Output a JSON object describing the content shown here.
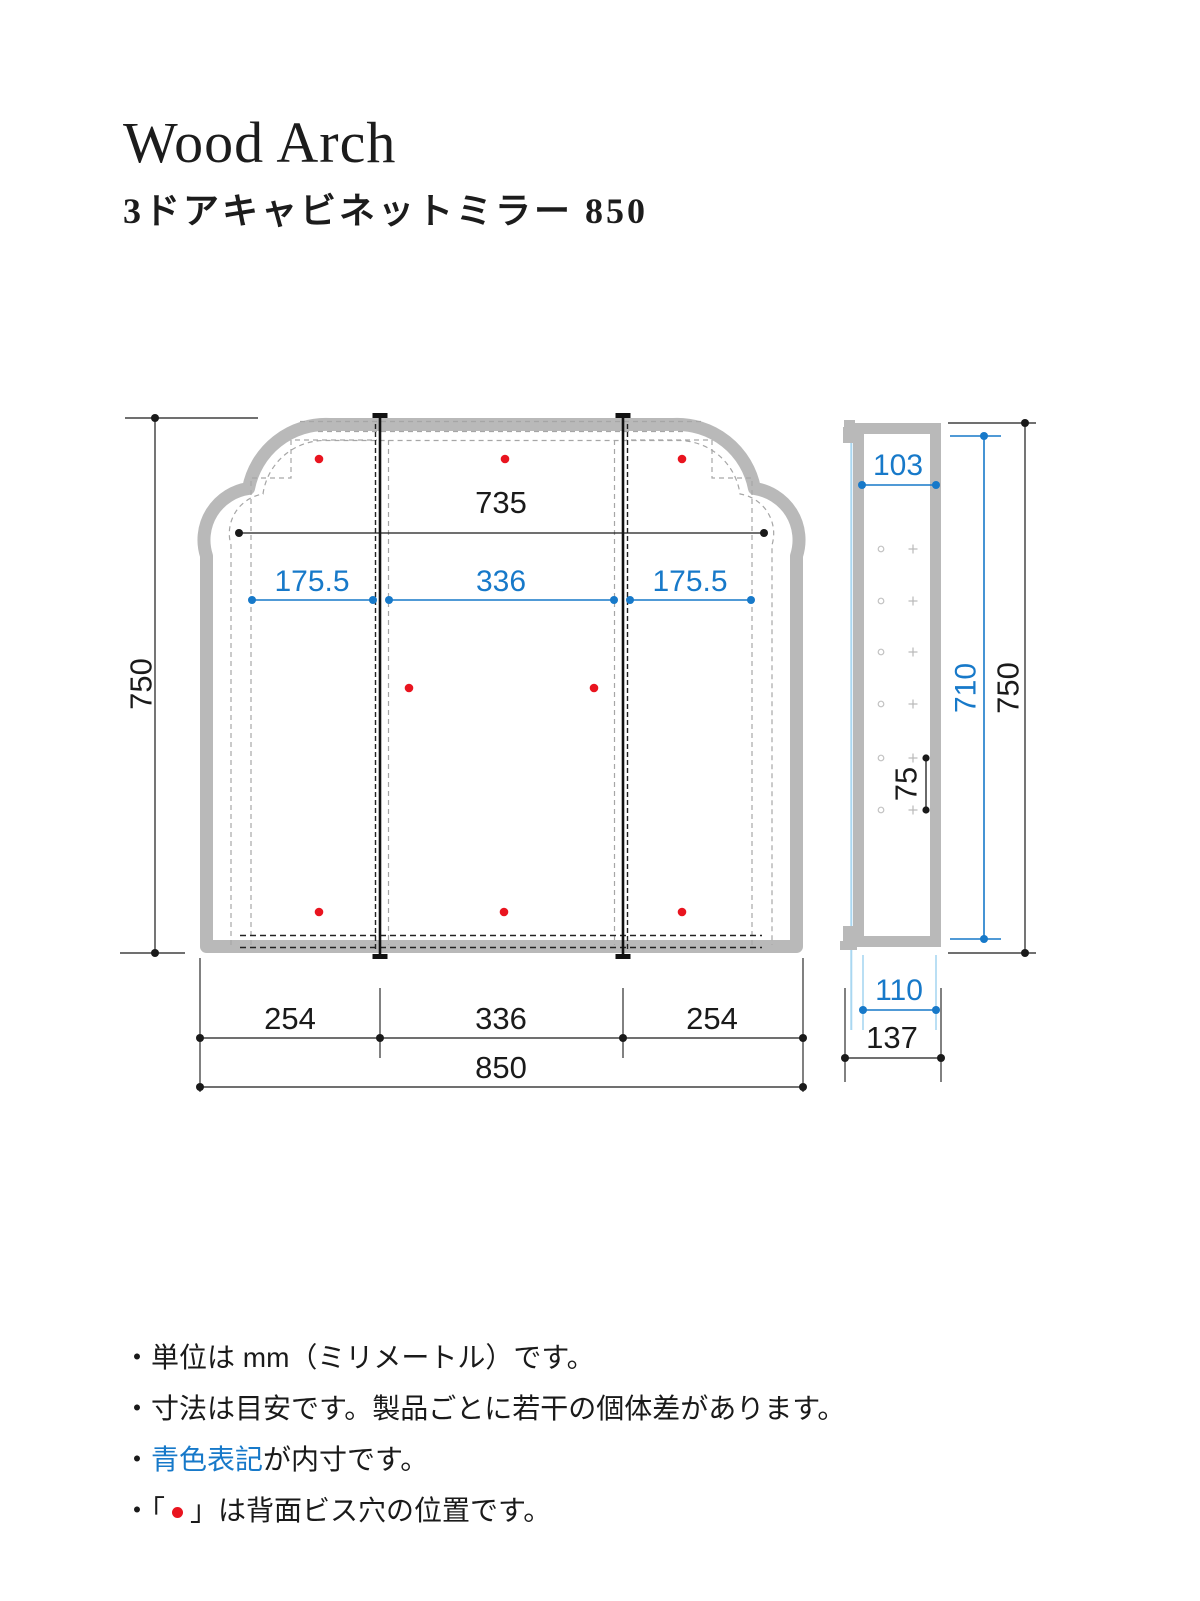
{
  "header": {
    "brand": "Wood Arch",
    "product": "3ドアキャビネットミラー 850"
  },
  "front_view": {
    "dims": {
      "inner_width_top": "735",
      "inner_door_left": "175.5",
      "inner_door_center": "336",
      "inner_door_right": "175.5",
      "height": "750",
      "door_left": "254",
      "door_center": "336",
      "door_right": "254",
      "total_width": "850"
    }
  },
  "side_view": {
    "dims": {
      "inner_top_depth": "103",
      "inner_height": "710",
      "height": "750",
      "hole_pitch": "75",
      "inner_depth": "110",
      "total_depth": "137"
    }
  },
  "notes": {
    "n1": "・単位は mm（ミリメートル）です。",
    "n2": "・寸法は目安です。製品ごとに若干の個体差があります。",
    "n3_bullet": "・",
    "n3_blue": "青色表記",
    "n3_rest": "が内寸です。",
    "n4_prefix": "・「",
    "n4_suffix": "」は背面ビス穴の位置です。"
  },
  "colors": {
    "dimension_blue": "#1779c9",
    "light_blue": "#a9d7f1",
    "screw_hole_red": "#e9141f",
    "cabinet_gray": "#b9b9b9",
    "line_black": "#1a1a1a"
  }
}
